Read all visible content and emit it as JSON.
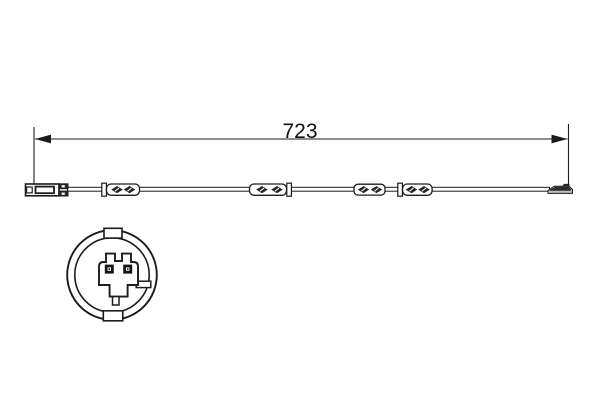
{
  "canvas": {
    "background": "#ffffff",
    "ink_color": "#1c1c1c",
    "metal_gray": "#bfbfbf",
    "dark_fill": "#262626"
  },
  "dimension": {
    "label": "723"
  },
  "parts": {
    "drawing": "brake-wear-sensor-line-drawing",
    "connector": "flat-plug-connector-side-view",
    "cable": "sensor-lead-cable",
    "splice": "overmolded-cable-splice",
    "sensor_tip": "wear-sensor-tip",
    "face_view": "connector-face-detail-view"
  }
}
